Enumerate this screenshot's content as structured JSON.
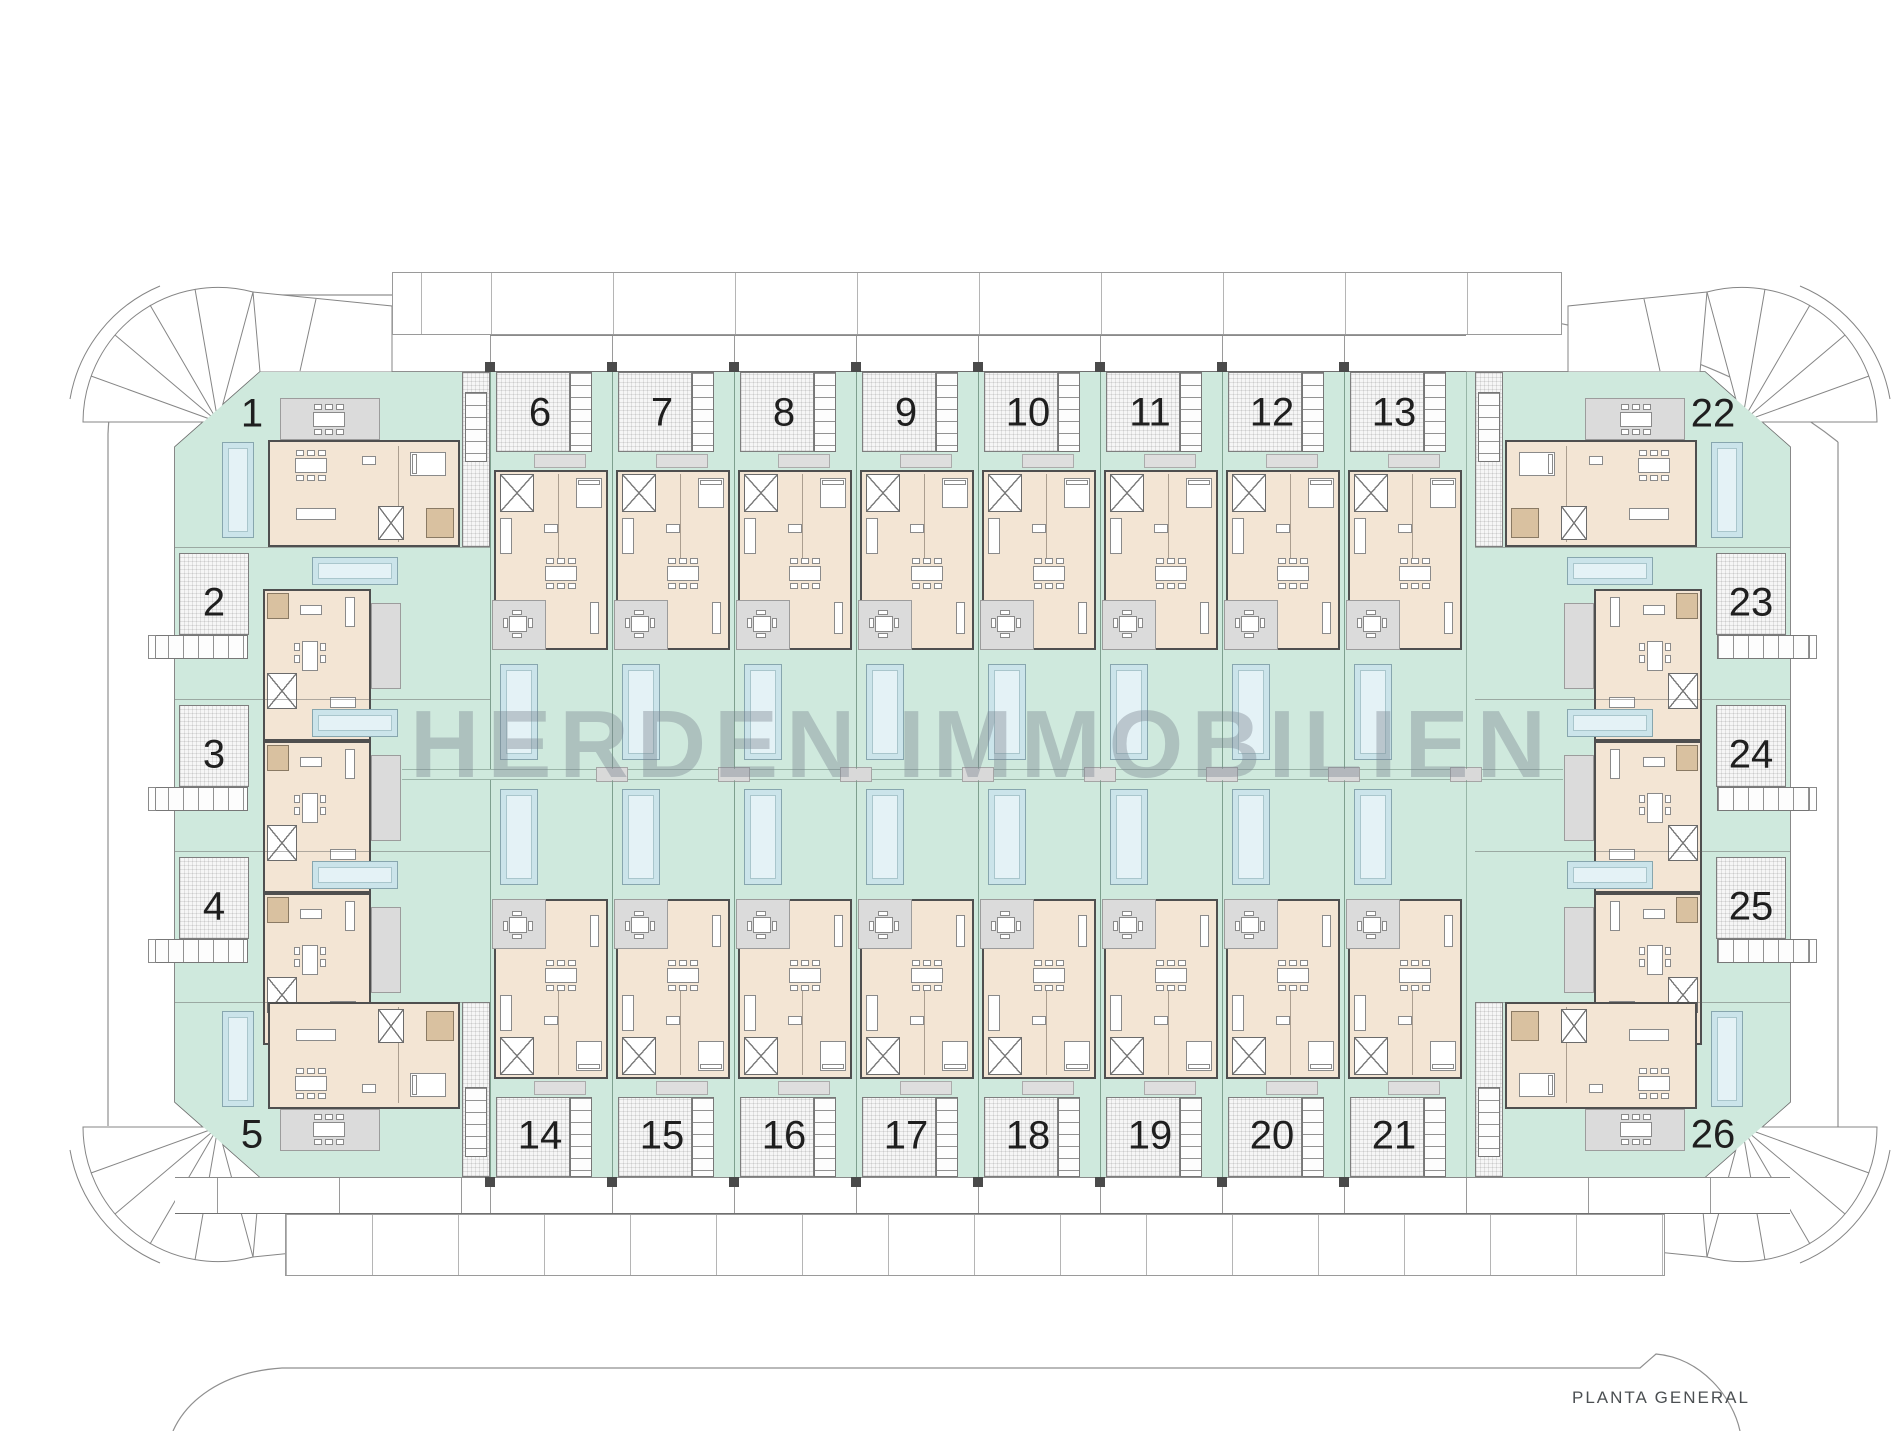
{
  "watermark": "HERDEN IMMOBILIEN",
  "plan_title": "PLANTA GENERAL",
  "units": {
    "top_row": [
      "6",
      "7",
      "8",
      "9",
      "10",
      "11",
      "12",
      "13"
    ],
    "bottom_row": [
      "14",
      "15",
      "16",
      "17",
      "18",
      "19",
      "20",
      "21"
    ],
    "left_column": [
      "2",
      "3",
      "4"
    ],
    "right_column": [
      "23",
      "24",
      "25"
    ],
    "corner_top_left": "1",
    "corner_top_right": "22",
    "corner_bottom_left": "5",
    "corner_bottom_right": "26"
  },
  "colors": {
    "garden_green": "#cfe9dd",
    "pool_blue": "#cbe4ea",
    "pool_inner": "#e4f2f6",
    "house_beige": "#f3e5d4",
    "patio_gray": "#dbdbdb",
    "wall_dark": "#4f4f4f",
    "hatch_gray": "#f6f6f6",
    "label_black": "#1f1f1f",
    "watermark_gray": "#7a8590",
    "boundary_gray": "#8f8f8f"
  }
}
